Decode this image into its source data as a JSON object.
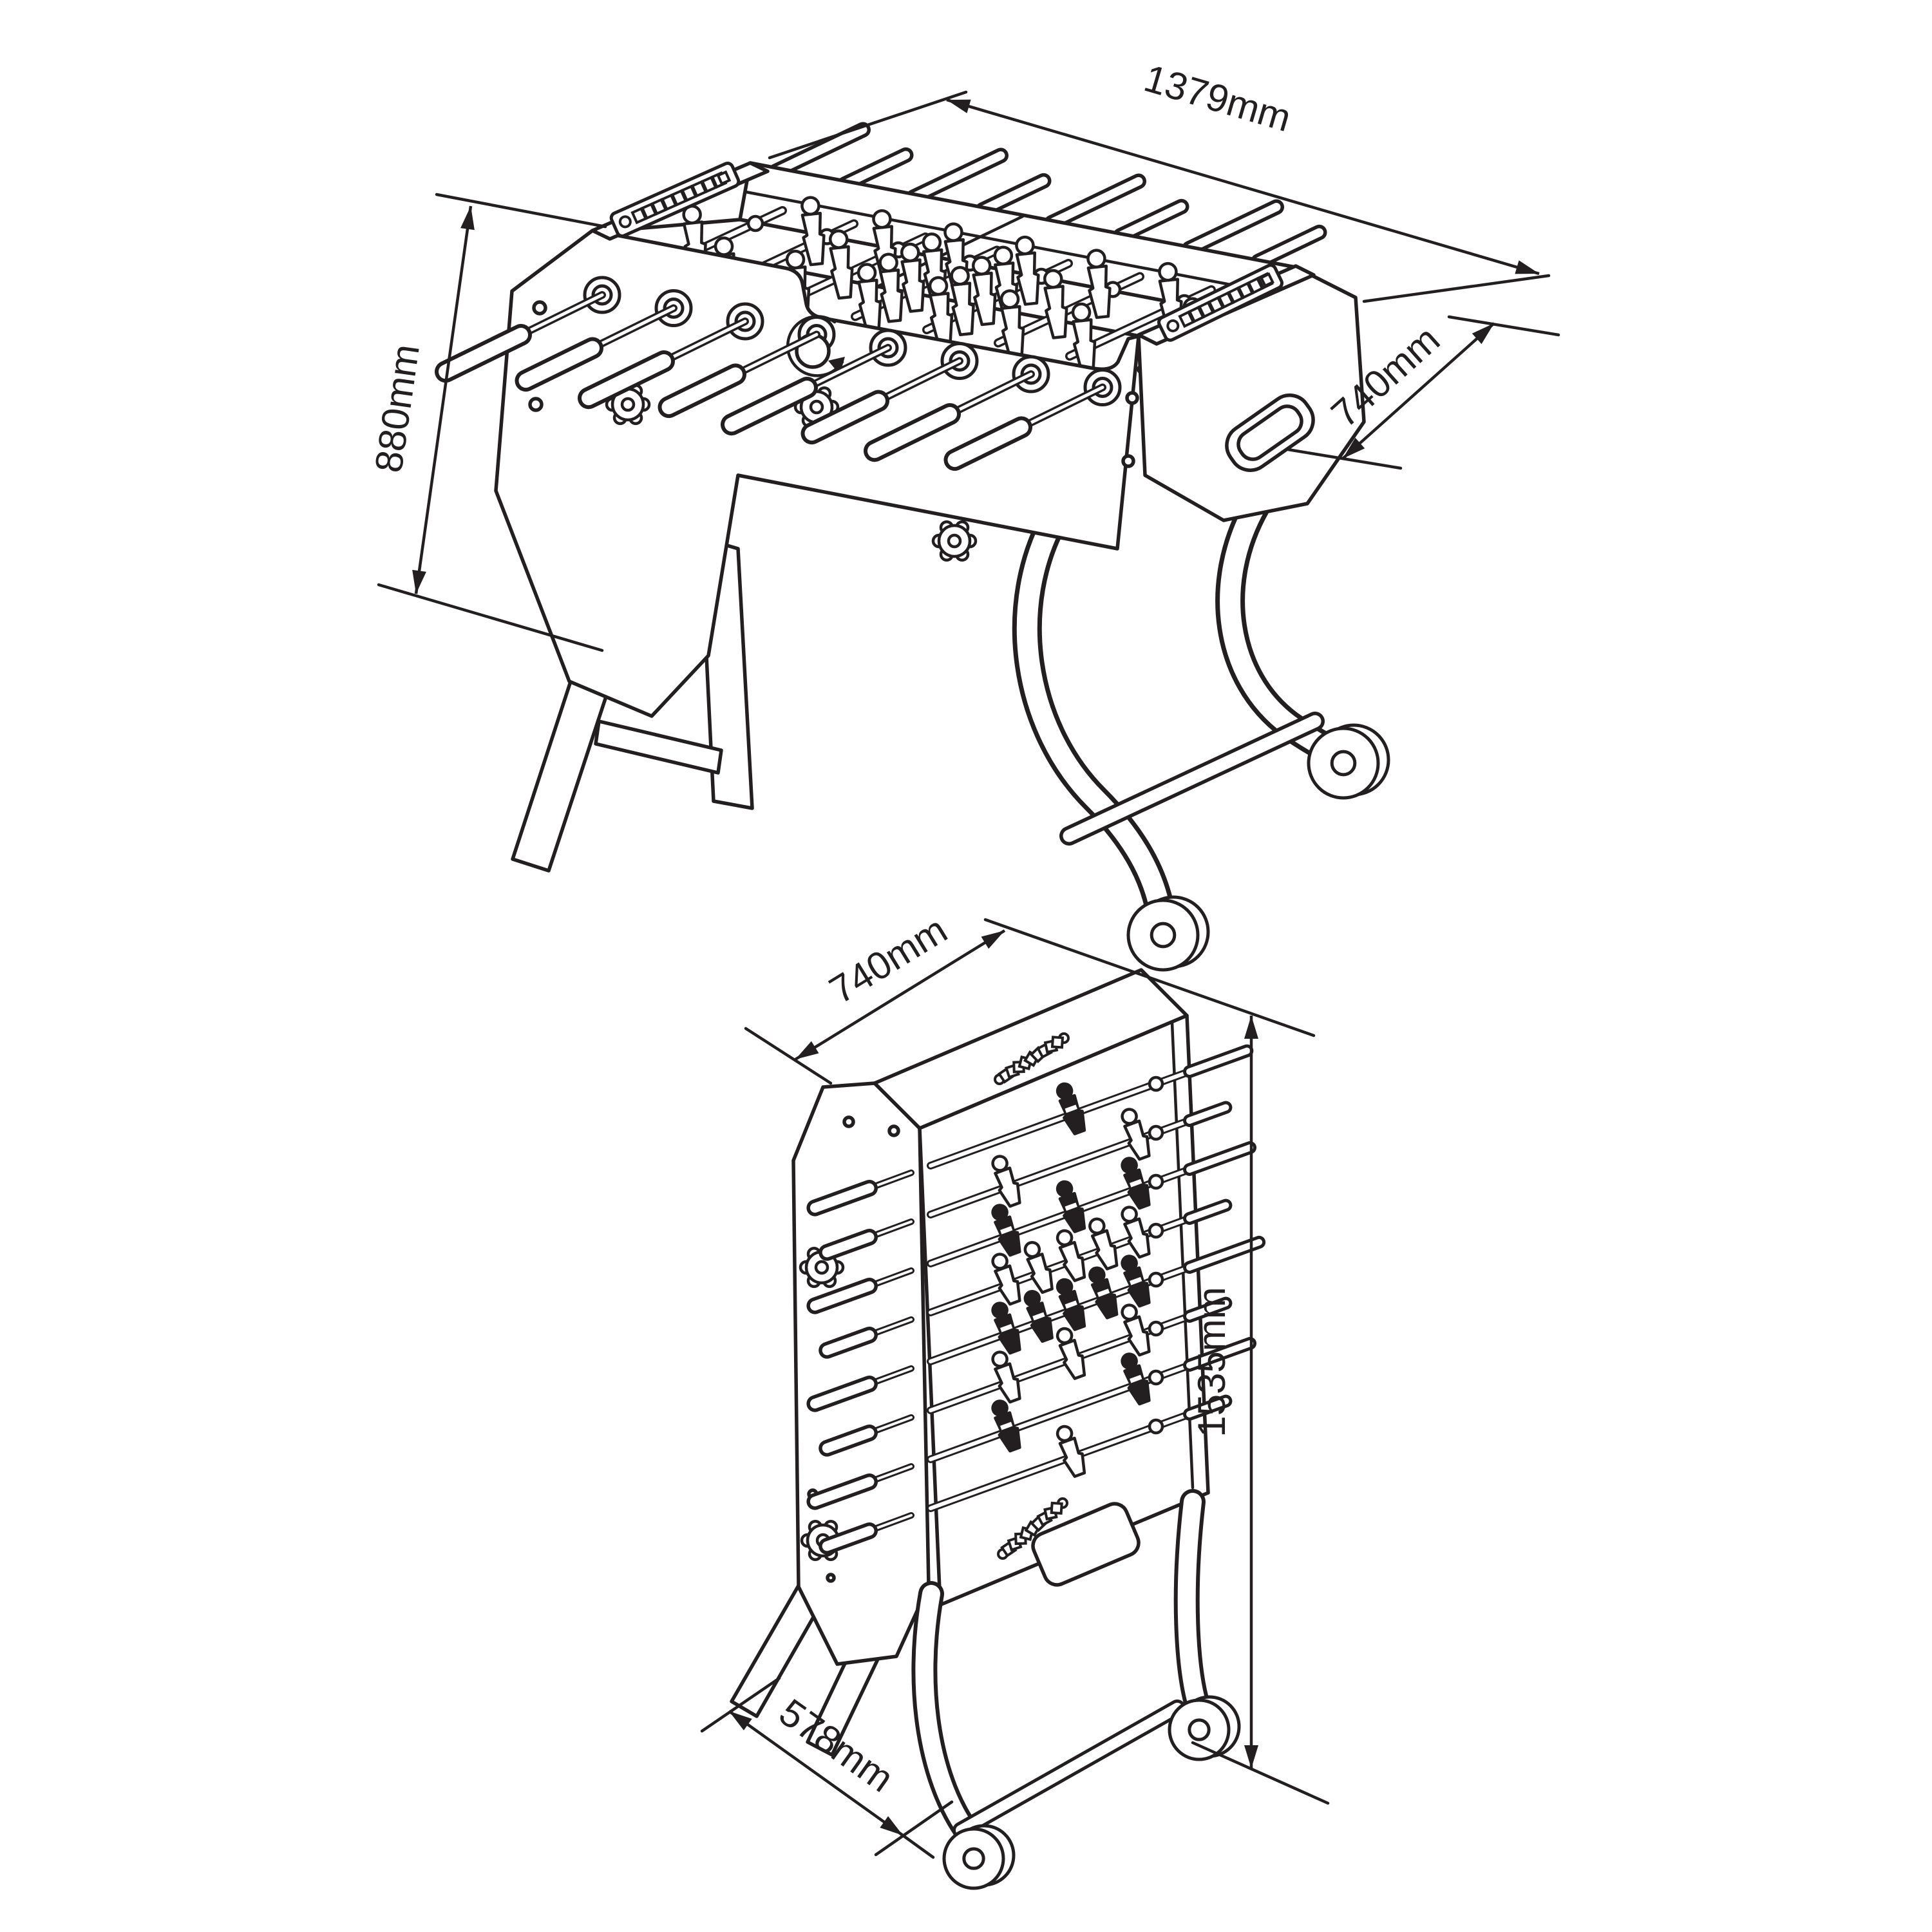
{
  "diagram": {
    "type": "technical-dimension-drawing",
    "subject": "foldable foosball table",
    "line_color": "#231f20",
    "background_color": "#ffffff"
  },
  "labels": {
    "assembled_length": "1379mm",
    "assembled_height": "880mm",
    "assembled_depth": "740mm",
    "folded_width": "740mm",
    "folded_height": "1535mm",
    "folded_depth": "578mm"
  }
}
